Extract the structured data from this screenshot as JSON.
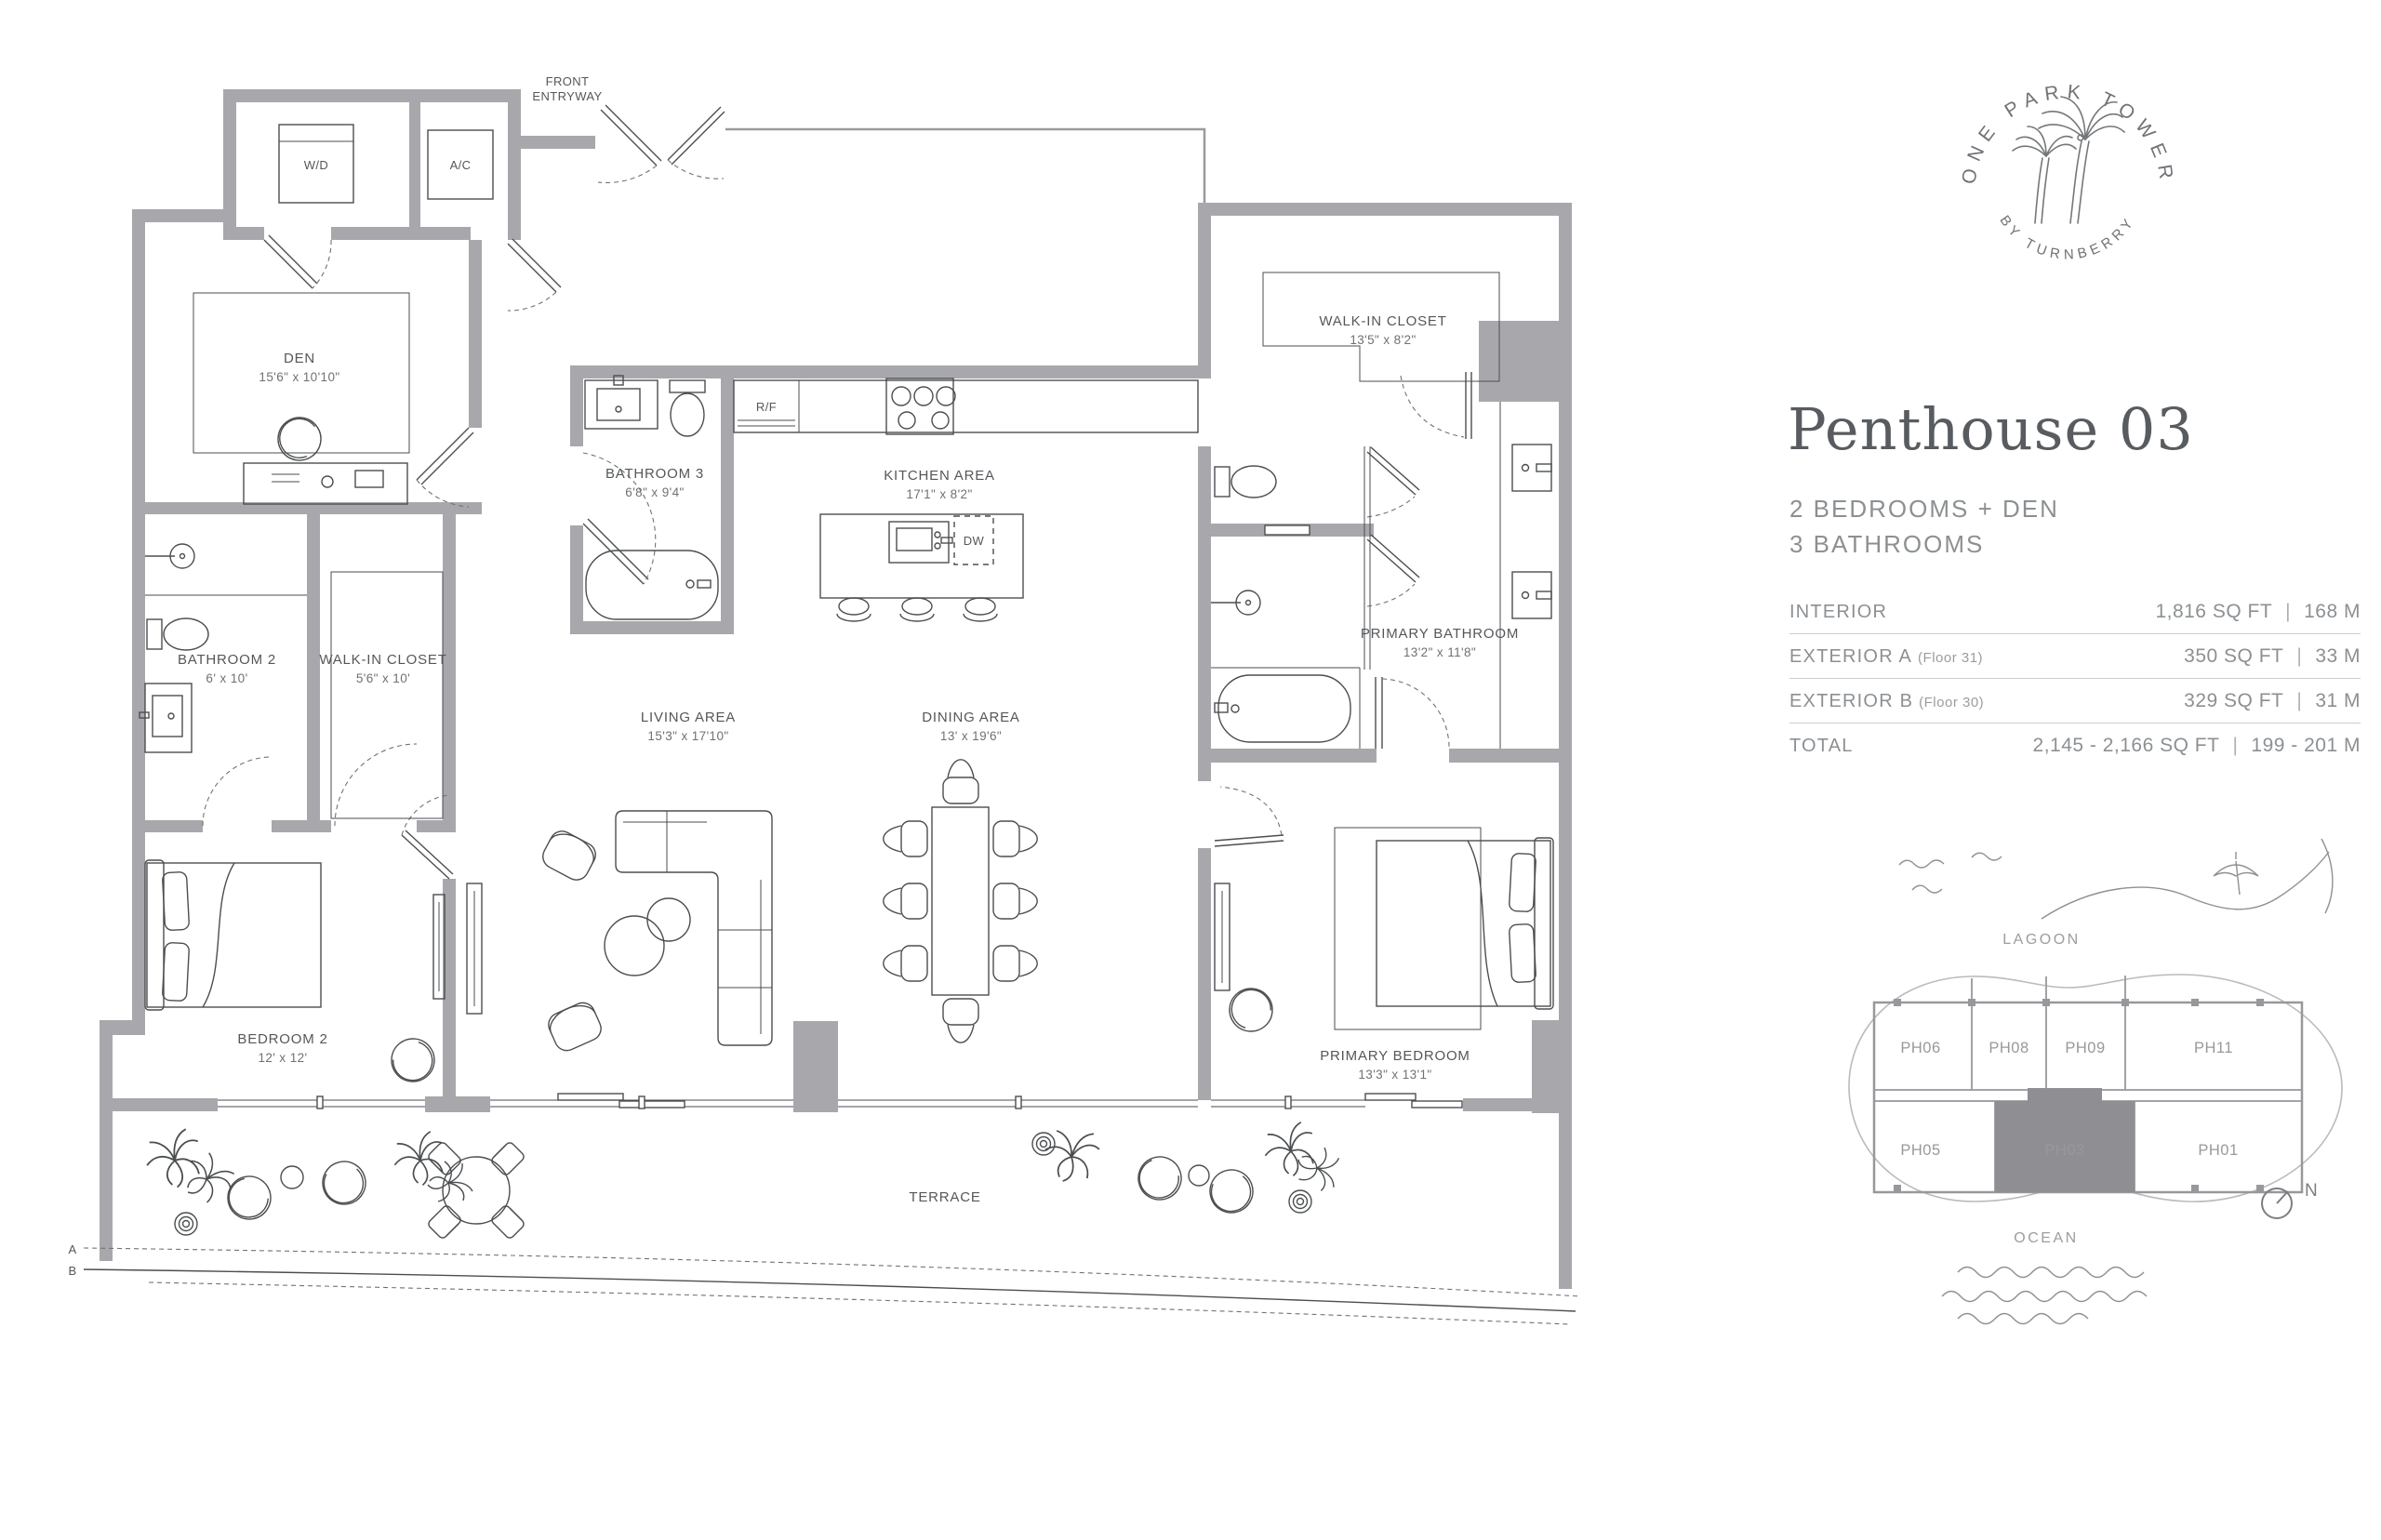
{
  "colors": {
    "wall_gray": "#a8a8ac",
    "unit_highlight": "#8e8e93",
    "line_ink": "#4b4e50",
    "label_ink": "#54575a",
    "muted_text": "#8c9093",
    "title_text": "#585c60",
    "rule": "#cbcdce"
  },
  "brand": {
    "arc_top": "ONE PARK TOWER",
    "arc_bottom": "BY TURNBERRY"
  },
  "header": {
    "title": "Penthouse 03",
    "subtitle_line1": "2 BEDROOMS + DEN",
    "subtitle_line2": "3 BATHROOMS"
  },
  "specs": {
    "separator": "|",
    "rows": [
      {
        "label": "INTERIOR",
        "note": "",
        "sqft": "1,816 SQ FT",
        "metric": "168 M"
      },
      {
        "label": "EXTERIOR A",
        "note": "(Floor 31)",
        "sqft": "350 SQ FT",
        "metric": "33 M"
      },
      {
        "label": "EXTERIOR B",
        "note": "(Floor 30)",
        "sqft": "329 SQ FT",
        "metric": "31 M"
      },
      {
        "label": "TOTAL",
        "note": "",
        "sqft": "2,145 - 2,166 SQ FT",
        "metric": "199 - 201 M"
      }
    ]
  },
  "floorplan": {
    "entry": {
      "line1": "FRONT",
      "line2": "ENTRYWAY"
    },
    "wd": "W/D",
    "ac": "A/C",
    "rf": "R/F",
    "dw": "DW",
    "den": {
      "name": "DEN",
      "dims": "15'6\" x 10'10\""
    },
    "bathroom3": {
      "name": "BATHROOM 3",
      "dims": "6'8\" x 9'4\""
    },
    "kitchen": {
      "name": "KITCHEN AREA",
      "dims": "17'1\" x 8'2\""
    },
    "bathroom2": {
      "name": "BATHROOM 2",
      "dims": "6' x 10'"
    },
    "closet2": {
      "name": "WALK-IN CLOSET",
      "dims": "5'6\" x 10'"
    },
    "bedroom2": {
      "name": "BEDROOM 2",
      "dims": "12' x 12'"
    },
    "living": {
      "name": "LIVING AREA",
      "dims": "15'3\" x 17'10\""
    },
    "dining": {
      "name": "DINING AREA",
      "dims": "13' x 19'6\""
    },
    "primary_closet": {
      "name": "WALK-IN CLOSET",
      "dims": "13'5\" x 8'2\""
    },
    "primary_bath": {
      "name": "PRIMARY BATHROOM",
      "dims": "13'2\" x 11'8\""
    },
    "primary_bedroom": {
      "name": "PRIMARY BEDROOM",
      "dims": "13'3\" x 13'1\""
    },
    "terrace": "TERRACE",
    "marker_a": "A",
    "marker_b": "B"
  },
  "keyplan": {
    "lagoon": "LAGOON",
    "ocean": "OCEAN",
    "north": "N",
    "units_top": [
      "PH06",
      "PH08",
      "PH09",
      "PH11"
    ],
    "units_bottom": [
      "PH05",
      "PH03",
      "PH01"
    ],
    "highlighted": "PH03"
  }
}
